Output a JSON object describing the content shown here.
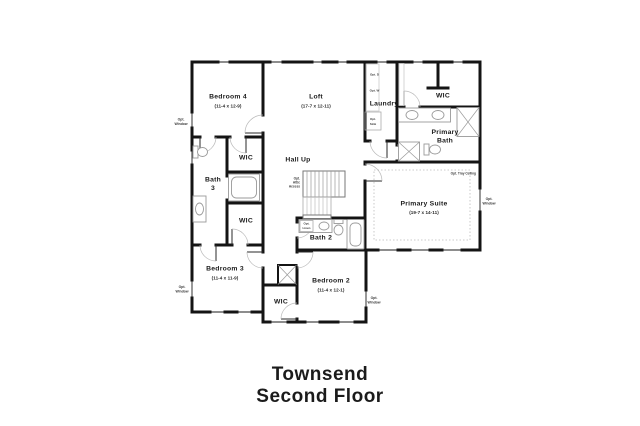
{
  "title": {
    "line1": "Townsend",
    "line2": "Second Floor"
  },
  "plan": {
    "rooms": {
      "bedroom4": {
        "name": "Bedroom 4",
        "dims": "(11-4 x 12-9)"
      },
      "loft": {
        "name": "Loft",
        "dims": "(17-7 x 12-11)"
      },
      "laundry": {
        "name": "Laundry"
      },
      "primary_wic": {
        "name": "WIC"
      },
      "primary_bath": {
        "line1": "Primary",
        "line2": "Bath"
      },
      "primary_suite": {
        "name": "Primary Suite",
        "dims": "(19-7 x 14-11)"
      },
      "hall": {
        "name": "Hall Up"
      },
      "bedroom4_wic": {
        "name": "WIC"
      },
      "bath3": {
        "line1": "Bath",
        "line2": "3"
      },
      "bedroom3_wic": {
        "name": "WIC"
      },
      "bedroom3": {
        "name": "Bedroom 3",
        "dims": "(11-4 x 11-9)"
      },
      "bath2": {
        "name": "Bath 2"
      },
      "bedroom2": {
        "name": "Bedroom 2",
        "dims": "(11-4 x 12-1)"
      },
      "bedroom2_wic": {
        "name": "WIC"
      }
    },
    "annotations": {
      "opt_window": {
        "line1": "Opt.",
        "line2": "Window"
      },
      "opt_tray_ceiling": "Opt. Tray Ceiling",
      "opt_dryer": "Opt. D",
      "opt_washer": "Opt. W",
      "opt_sink": {
        "line1": "Opt.",
        "line2": "Sink"
      },
      "opt_linen": {
        "line1": "Opt.",
        "line2": "Linen"
      },
      "attic": {
        "line1": "Opt.",
        "line2": "Attic",
        "line3": "Access"
      }
    },
    "colors": {
      "wall": "#141414",
      "fixture": "#9a9a9a",
      "text": "#1d1d1d"
    }
  }
}
